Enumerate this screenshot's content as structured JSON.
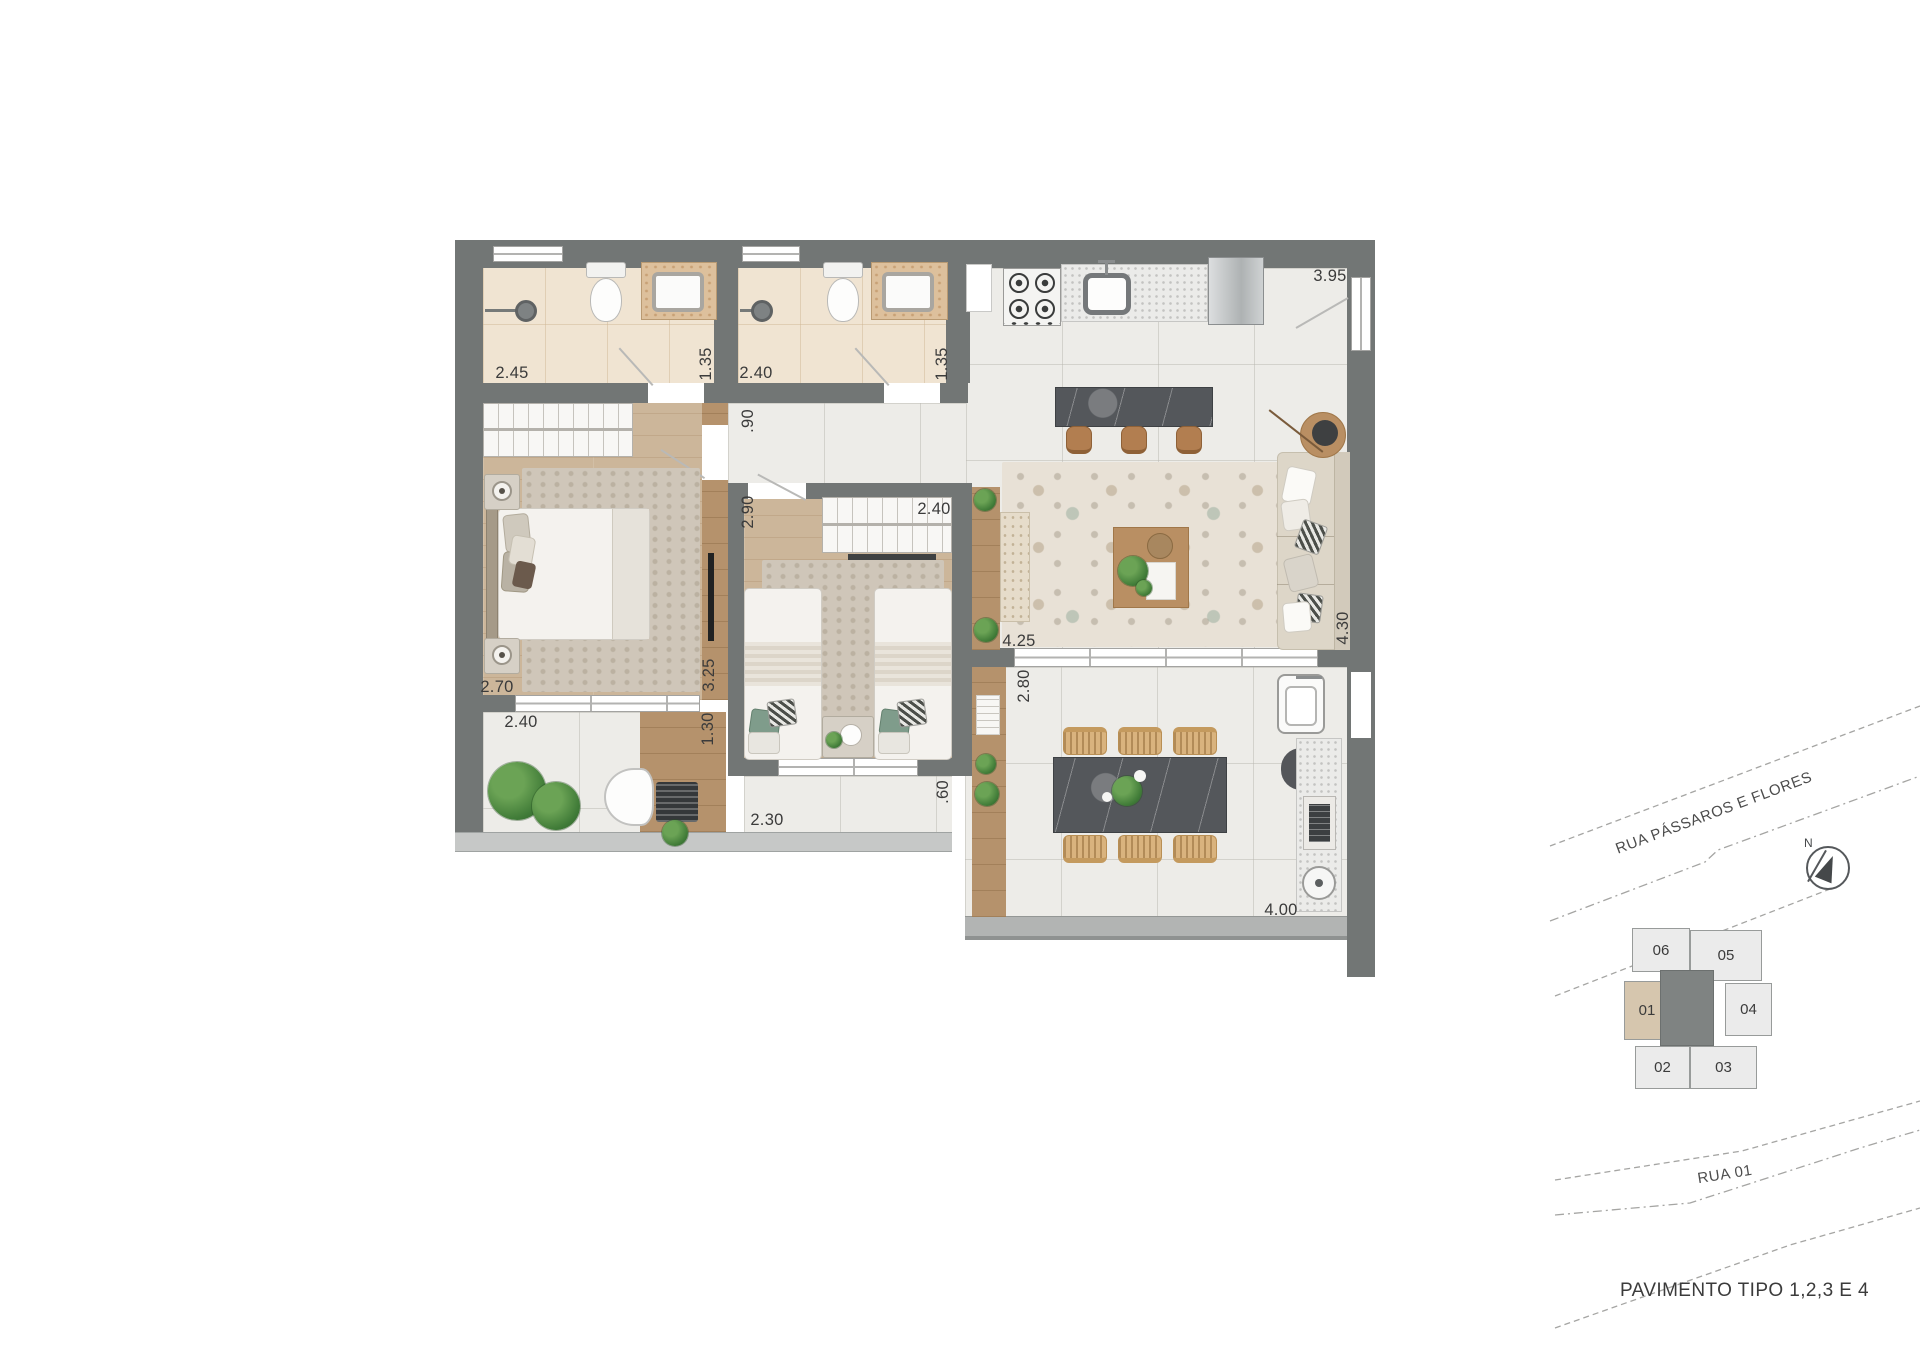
{
  "caption": "PAVIMENTO TIPO 1,2,3 E 4",
  "plan": {
    "dims": {
      "bath1_w": "2.45",
      "bath1_d": "1.35",
      "bath2_w": "2.40",
      "bath2_d": "1.35",
      "kitchen_l": "3.95",
      "hall_w": ".90",
      "bed2_entry": "2.90",
      "bed2_w": "2.40",
      "bed1_w": "2.70",
      "bed1_d": "3.25",
      "office_w": "2.40",
      "office_d": "1.30",
      "living_w": "4.25",
      "living_d": "4.30",
      "terrace_d": "2.80",
      "balcony2_d": ".60",
      "balcony2_w": "2.30",
      "terrace_w": "4.00"
    }
  },
  "key_plan": {
    "streets": {
      "street1": "RUA PÁSSAROS E FLORES",
      "street2": "RUA 01"
    },
    "compass": {
      "label": "N"
    },
    "units": {
      "u06": "06",
      "u05": "05",
      "u01": "01",
      "u04": "04",
      "u02": "02",
      "u03": "03"
    },
    "highlighted_unit": "01"
  },
  "colors": {
    "wall": "#727675",
    "unit_highlight": "#D6C6AE"
  }
}
